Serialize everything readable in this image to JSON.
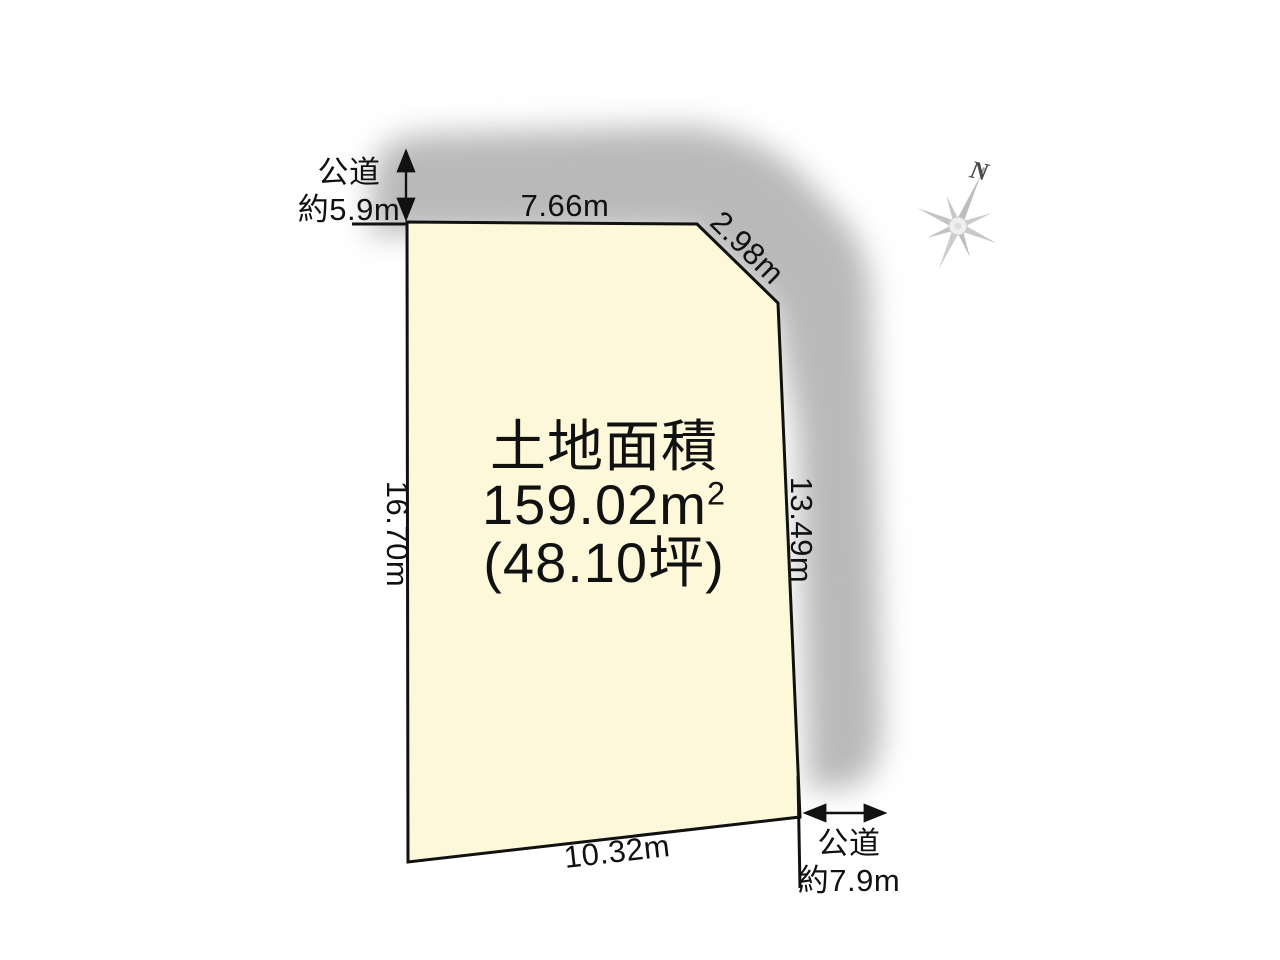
{
  "diagram": {
    "area": {
      "title": "土地面積",
      "value": "159.02m",
      "sup": "2",
      "tsubo": "(48.10坪)"
    },
    "dimensions": {
      "top": "7.66m",
      "diagonal": "2.98m",
      "left": "16.70m",
      "right": "13.49m",
      "bottom": "10.32m"
    },
    "roads": {
      "top": {
        "name": "公道",
        "width": "約5.9m"
      },
      "bottom": {
        "name": "公道",
        "width": "約7.9m"
      }
    },
    "compass": {
      "north": "N"
    },
    "colors": {
      "parcel_fill": "#fdf8da",
      "shade": "#b9b9b9",
      "outline": "#111111"
    }
  }
}
